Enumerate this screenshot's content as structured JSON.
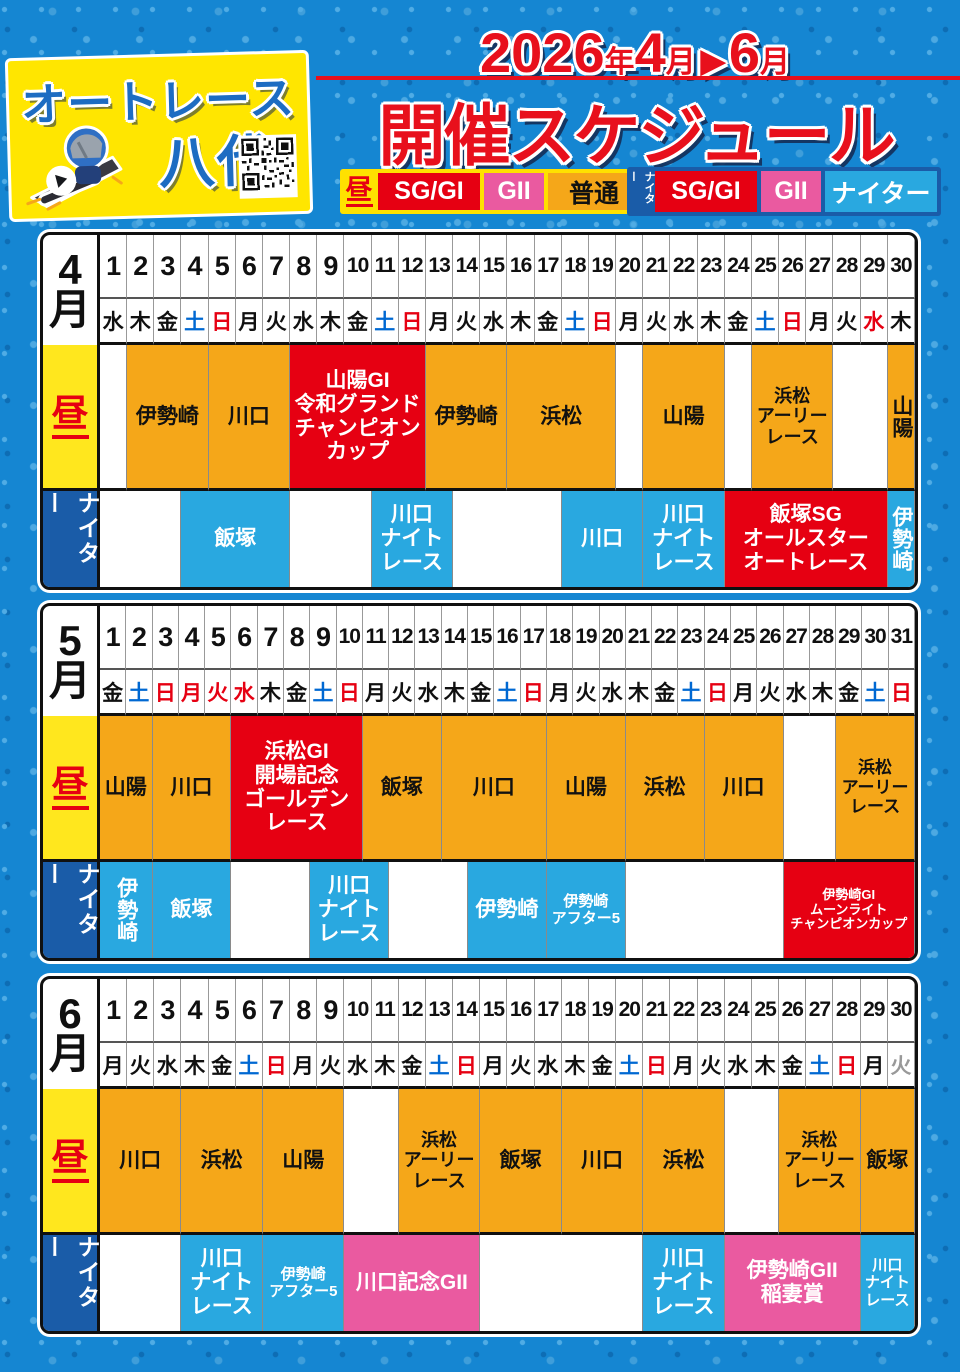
{
  "colors": {
    "background_blue": "#1586d2",
    "accent_red": "#e60012",
    "accent_pink": "#ea5aa0",
    "accent_orange": "#f5a719",
    "accent_lightblue": "#29a8e0",
    "accent_darkblue": "#1a5ca8",
    "accent_yellow": "#ffe600",
    "saturday_blue": "#0068d2",
    "sunday_red": "#e60012",
    "gray_day": "#999999"
  },
  "logo": {
    "line1": "オートレース",
    "line2": "八代"
  },
  "header": {
    "year": "2026",
    "year_unit": "年",
    "month_from": "4",
    "month_unit1": "月",
    "arrow": "▶",
    "month_to": "6",
    "month_unit2": "月",
    "title": "開催スケジュール"
  },
  "legend": {
    "day": {
      "label": "昼",
      "items": [
        {
          "label": "SG/GI",
          "type": "sg"
        },
        {
          "label": "GII",
          "type": "g2"
        },
        {
          "label": "普通",
          "type": "n"
        }
      ]
    },
    "night": {
      "label": "ナイター",
      "items": [
        {
          "label": "SG/GI",
          "type": "sg"
        },
        {
          "label": "GII",
          "type": "g2"
        },
        {
          "label": "ナイター",
          "type": "nt"
        }
      ]
    }
  },
  "row_labels": {
    "day": "昼",
    "night": "ナイター"
  },
  "months": [
    {
      "id": "april",
      "label": "4\n月",
      "days": [
        [
          "1",
          "水",
          "k"
        ],
        [
          "2",
          "木",
          "k"
        ],
        [
          "3",
          "金",
          "k"
        ],
        [
          "4",
          "土",
          "b"
        ],
        [
          "5",
          "日",
          "r"
        ],
        [
          "6",
          "月",
          "k"
        ],
        [
          "7",
          "火",
          "k"
        ],
        [
          "8",
          "水",
          "k"
        ],
        [
          "9",
          "木",
          "k"
        ],
        [
          "10",
          "金",
          "k"
        ],
        [
          "11",
          "土",
          "b"
        ],
        [
          "12",
          "日",
          "r"
        ],
        [
          "13",
          "月",
          "k"
        ],
        [
          "14",
          "火",
          "k"
        ],
        [
          "15",
          "水",
          "k"
        ],
        [
          "16",
          "木",
          "k"
        ],
        [
          "17",
          "金",
          "k"
        ],
        [
          "18",
          "土",
          "b"
        ],
        [
          "19",
          "日",
          "r"
        ],
        [
          "20",
          "月",
          "k"
        ],
        [
          "21",
          "火",
          "k"
        ],
        [
          "22",
          "水",
          "k"
        ],
        [
          "23",
          "木",
          "k"
        ],
        [
          "24",
          "金",
          "k"
        ],
        [
          "25",
          "土",
          "b"
        ],
        [
          "26",
          "日",
          "r"
        ],
        [
          "27",
          "月",
          "k"
        ],
        [
          "28",
          "火",
          "k"
        ],
        [
          "29",
          "水",
          "r"
        ],
        [
          "30",
          "木",
          "k"
        ]
      ],
      "day_events": [
        {
          "span": 1,
          "type": "e"
        },
        {
          "span": 3,
          "type": "n",
          "label": "伊勢崎"
        },
        {
          "span": 3,
          "type": "n",
          "label": "川口"
        },
        {
          "span": 5,
          "type": "sg",
          "label": "山陽GI\n令和グランド\nチャンピオン\nカップ"
        },
        {
          "span": 3,
          "type": "n",
          "label": "伊勢崎"
        },
        {
          "span": 4,
          "type": "n",
          "label": "浜松"
        },
        {
          "span": 1,
          "type": "e"
        },
        {
          "span": 3,
          "type": "n",
          "label": "山陽"
        },
        {
          "span": 1,
          "type": "e"
        },
        {
          "span": 3,
          "type": "n",
          "label": "浜松\nアーリー\nレース"
        },
        {
          "span": 2,
          "type": "e"
        },
        {
          "span": 1,
          "type": "n",
          "label": "山陽",
          "vertical": true
        }
      ],
      "night_events": [
        {
          "span": 3,
          "type": "e"
        },
        {
          "span": 4,
          "type": "nt",
          "label": "飯塚"
        },
        {
          "span": 3,
          "type": "e"
        },
        {
          "span": 3,
          "type": "nt",
          "label": "川口\nナイト\nレース"
        },
        {
          "span": 4,
          "type": "e"
        },
        {
          "span": 3,
          "type": "nt",
          "label": "川口"
        },
        {
          "span": 3,
          "type": "nt",
          "label": "川口\nナイト\nレース"
        },
        {
          "span": 6,
          "type": "sg",
          "label": "飯塚SG\nオールスター\nオートレース"
        },
        {
          "span": 1,
          "type": "nt",
          "label": "伊勢崎",
          "vertical": true
        }
      ]
    },
    {
      "id": "may",
      "label": "5\n月",
      "days": [
        [
          "1",
          "金",
          "k"
        ],
        [
          "2",
          "土",
          "b"
        ],
        [
          "3",
          "日",
          "r"
        ],
        [
          "4",
          "月",
          "r"
        ],
        [
          "5",
          "火",
          "r"
        ],
        [
          "6",
          "水",
          "r"
        ],
        [
          "7",
          "木",
          "k"
        ],
        [
          "8",
          "金",
          "k"
        ],
        [
          "9",
          "土",
          "b"
        ],
        [
          "10",
          "日",
          "r"
        ],
        [
          "11",
          "月",
          "k"
        ],
        [
          "12",
          "火",
          "k"
        ],
        [
          "13",
          "水",
          "k"
        ],
        [
          "14",
          "木",
          "k"
        ],
        [
          "15",
          "金",
          "k"
        ],
        [
          "16",
          "土",
          "b"
        ],
        [
          "17",
          "日",
          "r"
        ],
        [
          "18",
          "月",
          "k"
        ],
        [
          "19",
          "火",
          "k"
        ],
        [
          "20",
          "水",
          "k"
        ],
        [
          "21",
          "木",
          "k"
        ],
        [
          "22",
          "金",
          "k"
        ],
        [
          "23",
          "土",
          "b"
        ],
        [
          "24",
          "日",
          "r"
        ],
        [
          "25",
          "月",
          "k"
        ],
        [
          "26",
          "火",
          "k"
        ],
        [
          "27",
          "水",
          "k"
        ],
        [
          "28",
          "木",
          "k"
        ],
        [
          "29",
          "金",
          "k"
        ],
        [
          "30",
          "土",
          "b"
        ],
        [
          "31",
          "日",
          "r"
        ]
      ],
      "day_events": [
        {
          "span": 2,
          "type": "n",
          "label": "山陽"
        },
        {
          "span": 3,
          "type": "n",
          "label": "川口"
        },
        {
          "span": 5,
          "type": "sg",
          "label": "浜松GI\n開場記念\nゴールデン\nレース"
        },
        {
          "span": 3,
          "type": "n",
          "label": "飯塚"
        },
        {
          "span": 4,
          "type": "n",
          "label": "川口"
        },
        {
          "span": 3,
          "type": "n",
          "label": "山陽"
        },
        {
          "span": 3,
          "type": "n",
          "label": "浜松"
        },
        {
          "span": 3,
          "type": "n",
          "label": "川口"
        },
        {
          "span": 2,
          "type": "e"
        },
        {
          "span": 3,
          "type": "n",
          "label": "浜松\nアーリー\nレース"
        }
      ],
      "night_events": [
        {
          "span": 2,
          "type": "nt",
          "label": "伊勢崎",
          "vertical": true
        },
        {
          "span": 3,
          "type": "nt",
          "label": "飯塚"
        },
        {
          "span": 3,
          "type": "e"
        },
        {
          "span": 3,
          "type": "nt",
          "label": "川口\nナイト\nレース"
        },
        {
          "span": 3,
          "type": "e"
        },
        {
          "span": 3,
          "type": "nt",
          "label": "伊勢崎"
        },
        {
          "span": 3,
          "type": "nt",
          "label": "伊勢崎\nアフター5"
        },
        {
          "span": 6,
          "type": "e"
        },
        {
          "span": 5,
          "type": "sg",
          "label": "伊勢崎GI\nムーンライト\nチャンピオンカップ"
        }
      ]
    },
    {
      "id": "june",
      "label": "6\n月",
      "days": [
        [
          "1",
          "月",
          "k"
        ],
        [
          "2",
          "火",
          "k"
        ],
        [
          "3",
          "水",
          "k"
        ],
        [
          "4",
          "木",
          "k"
        ],
        [
          "5",
          "金",
          "k"
        ],
        [
          "6",
          "土",
          "b"
        ],
        [
          "7",
          "日",
          "r"
        ],
        [
          "8",
          "月",
          "k"
        ],
        [
          "9",
          "火",
          "k"
        ],
        [
          "10",
          "水",
          "k"
        ],
        [
          "11",
          "木",
          "k"
        ],
        [
          "12",
          "金",
          "k"
        ],
        [
          "13",
          "土",
          "b"
        ],
        [
          "14",
          "日",
          "r"
        ],
        [
          "15",
          "月",
          "k"
        ],
        [
          "16",
          "火",
          "k"
        ],
        [
          "17",
          "水",
          "k"
        ],
        [
          "18",
          "木",
          "k"
        ],
        [
          "19",
          "金",
          "k"
        ],
        [
          "20",
          "土",
          "b"
        ],
        [
          "21",
          "日",
          "r"
        ],
        [
          "22",
          "月",
          "k"
        ],
        [
          "23",
          "火",
          "k"
        ],
        [
          "24",
          "水",
          "k"
        ],
        [
          "25",
          "木",
          "k"
        ],
        [
          "26",
          "金",
          "k"
        ],
        [
          "27",
          "土",
          "b"
        ],
        [
          "28",
          "日",
          "r"
        ],
        [
          "29",
          "月",
          "k"
        ],
        [
          "30",
          "火",
          "g"
        ]
      ],
      "day_events": [
        {
          "span": 3,
          "type": "n",
          "label": "川口"
        },
        {
          "span": 3,
          "type": "n",
          "label": "浜松"
        },
        {
          "span": 3,
          "type": "n",
          "label": "山陽"
        },
        {
          "span": 2,
          "type": "e"
        },
        {
          "span": 3,
          "type": "n",
          "label": "浜松\nアーリー\nレース"
        },
        {
          "span": 3,
          "type": "n",
          "label": "飯塚"
        },
        {
          "span": 3,
          "type": "n",
          "label": "川口"
        },
        {
          "span": 3,
          "type": "n",
          "label": "浜松"
        },
        {
          "span": 2,
          "type": "e"
        },
        {
          "span": 3,
          "type": "n",
          "label": "浜松\nアーリー\nレース"
        },
        {
          "span": 2,
          "type": "n",
          "label": "飯塚"
        }
      ],
      "night_events": [
        {
          "span": 3,
          "type": "e"
        },
        {
          "span": 3,
          "type": "nt",
          "label": "川口\nナイト\nレース"
        },
        {
          "span": 3,
          "type": "nt",
          "label": "伊勢崎\nアフター5"
        },
        {
          "span": 5,
          "type": "g2",
          "label": "川口記念GII"
        },
        {
          "span": 6,
          "type": "e"
        },
        {
          "span": 3,
          "type": "nt",
          "label": "川口\nナイト\nレース"
        },
        {
          "span": 5,
          "type": "g2",
          "label": "伊勢崎GII\n稲妻賞"
        },
        {
          "span": 2,
          "type": "nt",
          "label": "川口\nナイト\nレース"
        }
      ]
    }
  ]
}
